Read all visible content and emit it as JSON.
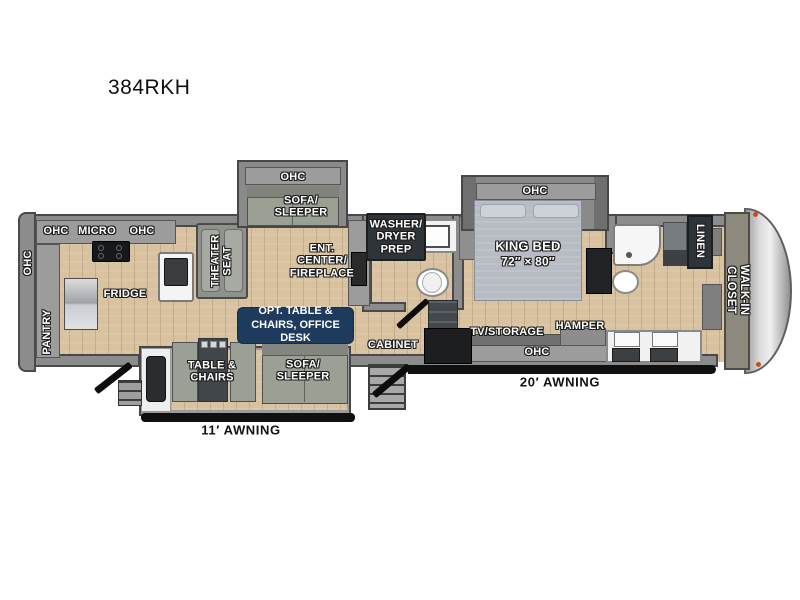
{
  "title": "384RKH",
  "colors": {
    "wall": "#8c8c8c",
    "wall_outline": "#4a4a4a",
    "floor_wood": "#d8c2a0",
    "navy_box": "#1e3a5c",
    "dark_box": "#2f3439",
    "awning_bar": "#111111",
    "front_cap": "#d6d6d6",
    "bed": "#b7bbc3"
  },
  "labels": {
    "kitchen": {
      "ohc_wall": "OHC",
      "ohc_top_left": "OHC",
      "micro": "MICRO",
      "ohc_top_right": "OHC",
      "pantry": "PANTRY",
      "fridge": "FRIDGE"
    },
    "living": {
      "theater_seat": "THEATER\nSEAT",
      "sofa_slide_ohc": "OHC",
      "sofa_slide": "SOFA/\nSLEEPER",
      "ent_center": "ENT.\nCENTER/\nFIREPLACE",
      "opt_table": "OPT. TABLE &\nCHAIRS, OFFICE DESK"
    },
    "mid": {
      "washer_dryer": "WASHER/\nDRYER\nPREP",
      "cabinet": "CABINET"
    },
    "bottom_slide": {
      "table_chairs": "TABLE &\nCHAIRS",
      "sofa_sleeper": "SOFA/\nSLEEPER",
      "awning_11": "11′ AWNING"
    },
    "bedroom": {
      "slide_ohc": "OHC",
      "king_bed": "KING BED",
      "king_size": "72″ × 80″",
      "tv_storage": "TV/STORAGE",
      "hamper": "HAMPER",
      "ohc_bottom": "OHC",
      "awning_20": "20′ AWNING"
    },
    "bath": {
      "linen": "LINEN"
    },
    "front": {
      "walk_in_closet": "WALK-IN CLOSET"
    }
  }
}
